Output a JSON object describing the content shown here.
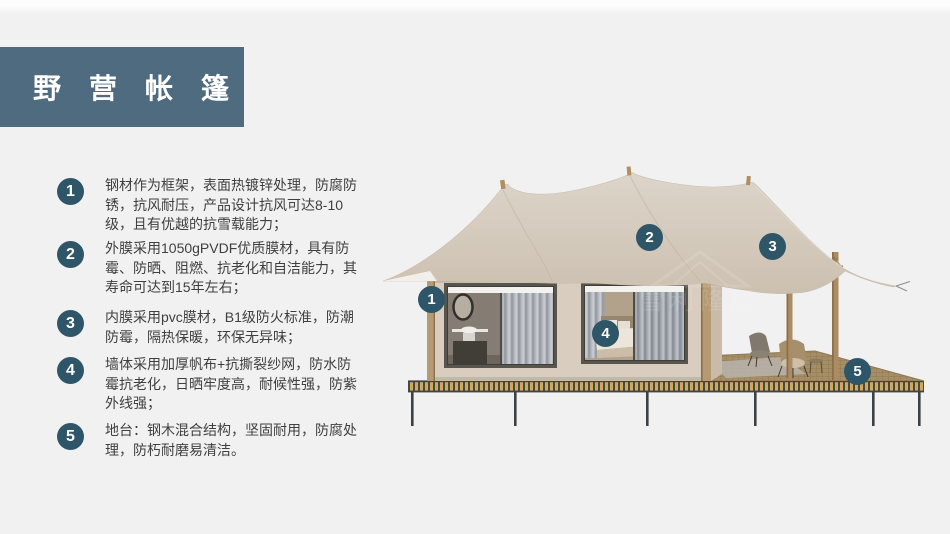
{
  "title": {
    "text": "野营帐篷"
  },
  "features": [
    {
      "num": "1",
      "text": "钢材作为框架，表面热镀锌处理，防腐防锈，抗风耐压，产品设计抗风可达8-10级，且有优越的抗雪载能力；"
    },
    {
      "num": "2",
      "text": "外膜采用1050gPVDF优质膜材，具有防霉、防晒、阻燃、抗老化和自洁能力，其寿命可达到15年左右；"
    },
    {
      "num": "3",
      "text": "内膜采用pvc膜材，B1级防火标准，防潮防霉，隔热保暖，环保无异味；"
    },
    {
      "num": "4",
      "text": "墙体采用加厚帆布+抗撕裂纱网，防水防霉抗老化，日晒牢度高，耐候性强，防紫外线强；"
    },
    {
      "num": "5",
      "text": "地台：钢木混合结构，坚固耐用，防腐处理，防朽耐磨易清洁。"
    }
  ],
  "callouts": [
    {
      "num": "1"
    },
    {
      "num": "2"
    },
    {
      "num": "3"
    },
    {
      "num": "4"
    },
    {
      "num": "5"
    }
  ],
  "illustration": {
    "name": "glamping-tent-render",
    "watermark": "雪利隆居"
  },
  "colors": {
    "accent_badge": "#2e5568",
    "title_block": "#4f6b80",
    "background": "#f1f1f2",
    "roof_fabric": "#d3c9bb",
    "wall": "#d8cdbf",
    "deck": "#a58d64"
  }
}
